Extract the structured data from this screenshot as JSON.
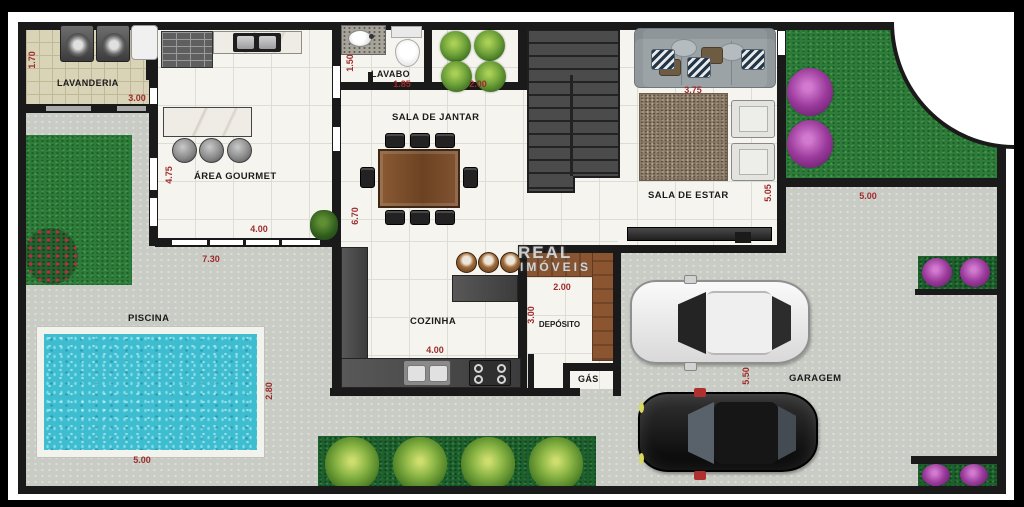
{
  "watermark": {
    "line1": "REAL",
    "line2": "IMÓVEIS"
  },
  "labels": {
    "lavanderia": "LAVANDERIA",
    "area_gourmet": "ÁREA GOURMET",
    "lavabo": "LAVABO",
    "sala_de_jantar": "SALA DE JANTAR",
    "sala_de_estar": "SALA DE ESTAR",
    "cozinha": "COZINHA",
    "deposito": "DEPÓSITO",
    "gas": "GÁS",
    "piscina": "PISCINA",
    "garagem": "GARAGEM"
  },
  "dims": {
    "lavanderia_h": "1.70",
    "lavanderia_w": "3.00",
    "gourmet_h": "4.75",
    "gourmet_w": "4.00",
    "patio_w": "7.30",
    "lavabo_h": "1.50",
    "lavabo_w": "1.85",
    "winter_garden_w": "2.00",
    "jantar_h": "6.70",
    "sofa_w": "3.75",
    "estar_h": "5.05",
    "side_grass_w": "5.00",
    "deposito_w": "2.00",
    "deposito_h": "3.00",
    "cozinha_w": "4.00",
    "piscina_w": "5.00",
    "piscina_h": "2.80",
    "garagem_h": "5.50"
  },
  "colors": {
    "wall": "#1a1a1a",
    "dimension_text": "#9e2b2b",
    "grass": "#2e7c3b",
    "pool_water": "#3fbdd0",
    "concrete": "#c9ccc5",
    "wood": "#8a5530",
    "flower_purple": "#9b3a9b"
  }
}
